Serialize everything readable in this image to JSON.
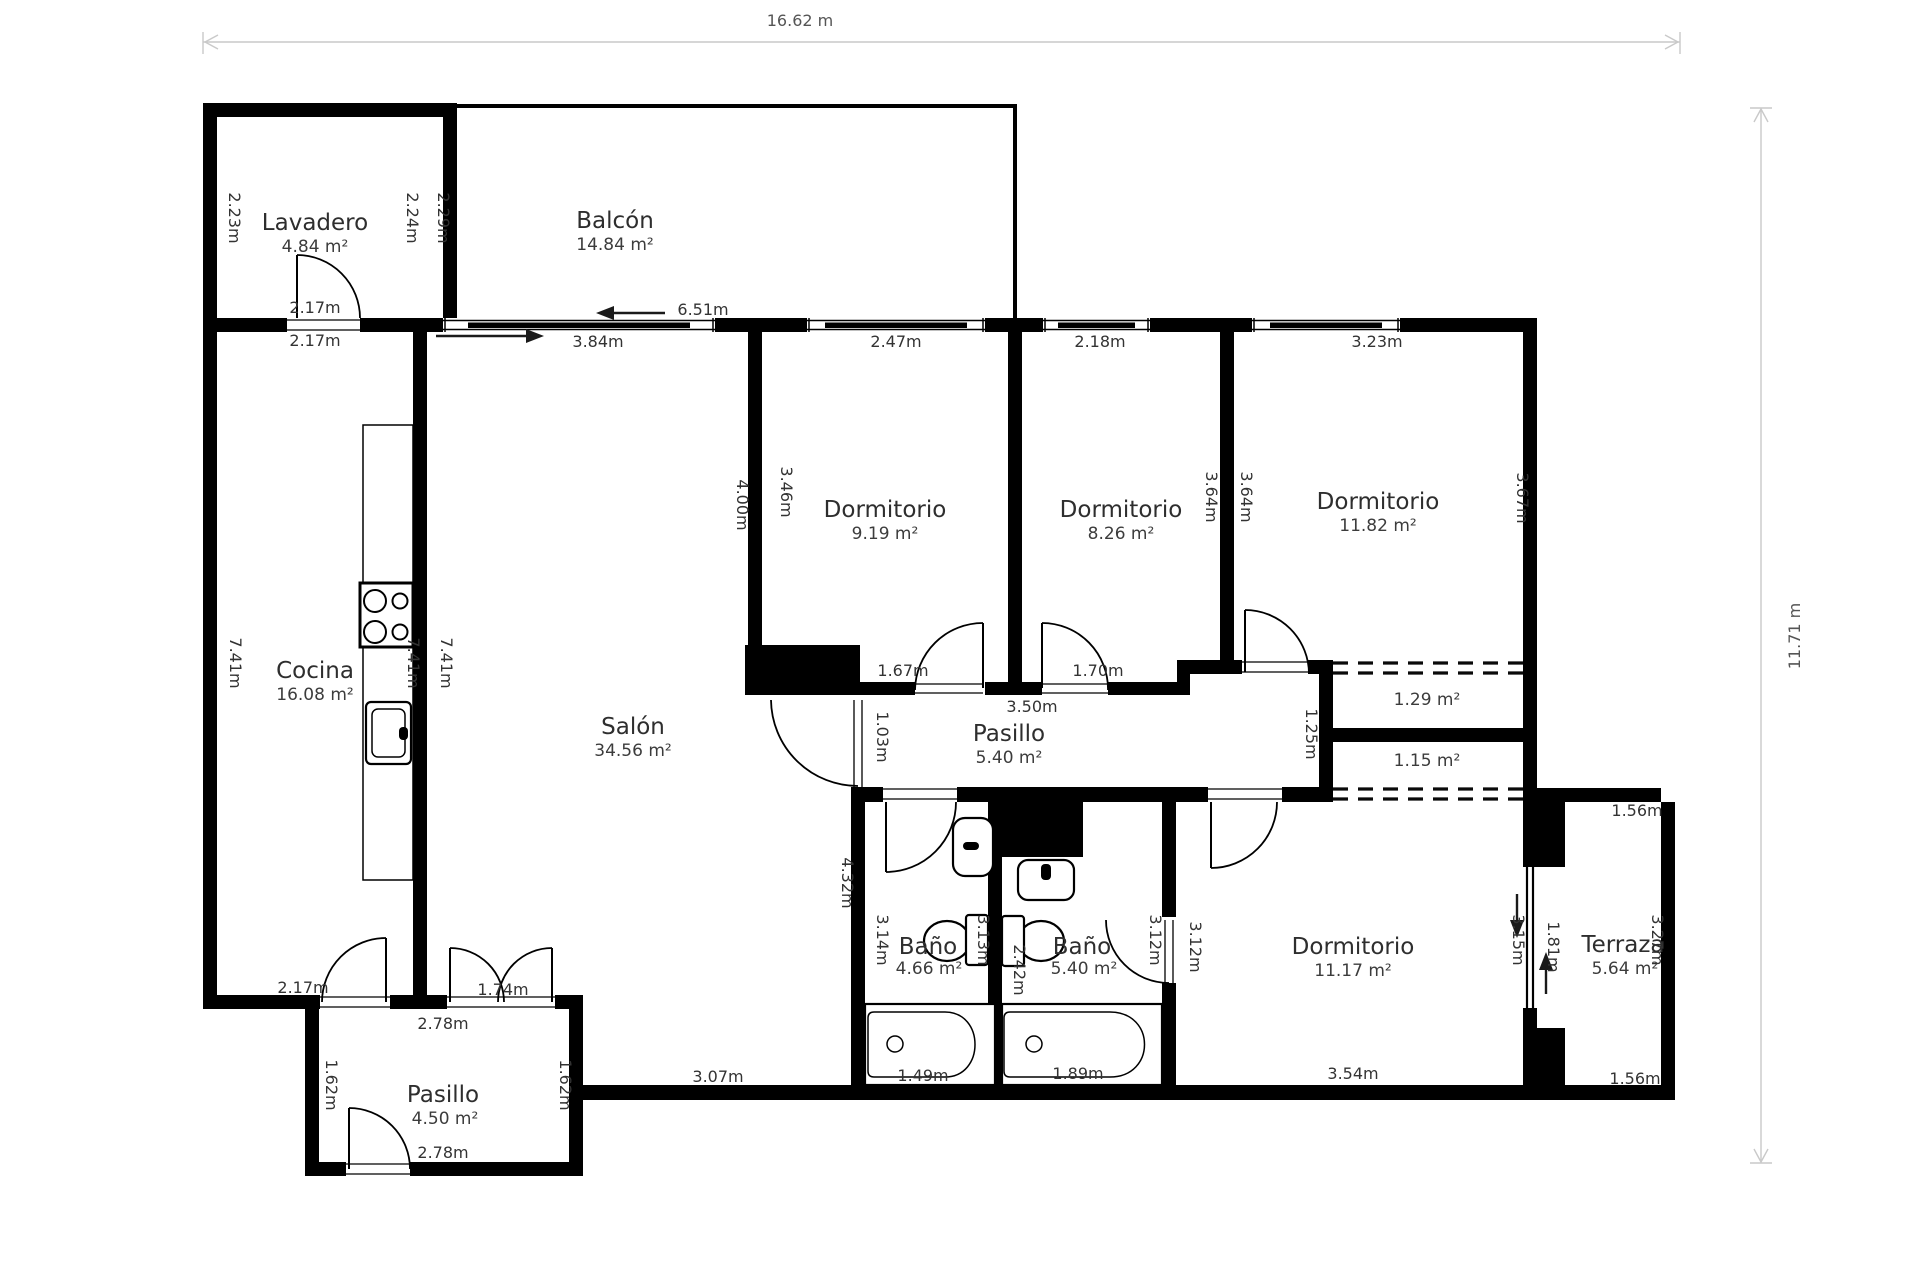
{
  "meta": {
    "width_label": "16.62 m",
    "height_label": "11.71 m"
  },
  "rooms": [
    {
      "id": "lavadero",
      "name": "Lavadero",
      "area": "4.84 m²"
    },
    {
      "id": "balcon",
      "name": "Balcón",
      "area": "14.84 m²"
    },
    {
      "id": "cocina",
      "name": "Cocina",
      "area": "16.08 m²"
    },
    {
      "id": "salon",
      "name": "Salón",
      "area": "34.56 m²"
    },
    {
      "id": "dormitorio-1",
      "name": "Dormitorio",
      "area": "9.19 m²"
    },
    {
      "id": "dormitorio-2",
      "name": "Dormitorio",
      "area": "8.26 m²"
    },
    {
      "id": "dormitorio-3",
      "name": "Dormitorio",
      "area": "11.82 m²"
    },
    {
      "id": "pasillo-1",
      "name": "Pasillo",
      "area": "5.40 m²"
    },
    {
      "id": "bano-1",
      "name": "Baño",
      "area": "4.66 m²"
    },
    {
      "id": "bano-2",
      "name": "Baño",
      "area": "5.40 m²"
    },
    {
      "id": "dormitorio-4",
      "name": "Dormitorio",
      "area": "11.17 m²"
    },
    {
      "id": "terraza",
      "name": "Terraza",
      "area": "5.64 m²"
    },
    {
      "id": "pasillo-2",
      "name": "Pasillo",
      "area": "4.50 m²"
    }
  ],
  "closets": [
    {
      "area": "1.29 m²"
    },
    {
      "area": "1.15 m²"
    }
  ],
  "dims": {
    "lav_left": "2.23m",
    "lav_right": "2.24m",
    "balc_left": "2.29m",
    "lav_door_a": "2.17m",
    "lav_door_b": "2.17m",
    "balc_w": "6.51m",
    "salon_win": "3.84m",
    "d1_win": "2.47m",
    "d2_win": "2.18m",
    "d3_win": "3.23m",
    "d1_right": "3.46m",
    "salon_right_up": "4.00m",
    "d2_left": "3.64m",
    "d3_left": "3.64m",
    "d3_right": "3.67m",
    "coc_left": "7.41m",
    "coc_mid": "7.41m",
    "salon_left": "7.41m",
    "d1_door": "1.67m",
    "d2_door": "1.70m",
    "pas_w": "3.50m",
    "pas_door": "1.03m",
    "closet_h": "1.25m",
    "salon_right_low": "4.32m",
    "b1_left": "3.14m",
    "b1_right": "3.13m",
    "b2_left": "2.42m",
    "b2_right": "3.12m",
    "d4_left": "3.12m",
    "d4_right": "3.15m",
    "ter_door": "1.81m",
    "ter_right": "3.27m",
    "ter_top": "1.56m",
    "ter_bot": "1.56m",
    "d4_w": "3.54m",
    "salon_bot": "3.07m",
    "tub1": "1.49m",
    "tub2": "1.89m",
    "coc_door": "2.17m",
    "p2_top": "2.78m",
    "p2_door": "1.74m",
    "p2_left": "1.62m",
    "p2_right": "1.62m",
    "p2_bot": "2.78m"
  }
}
